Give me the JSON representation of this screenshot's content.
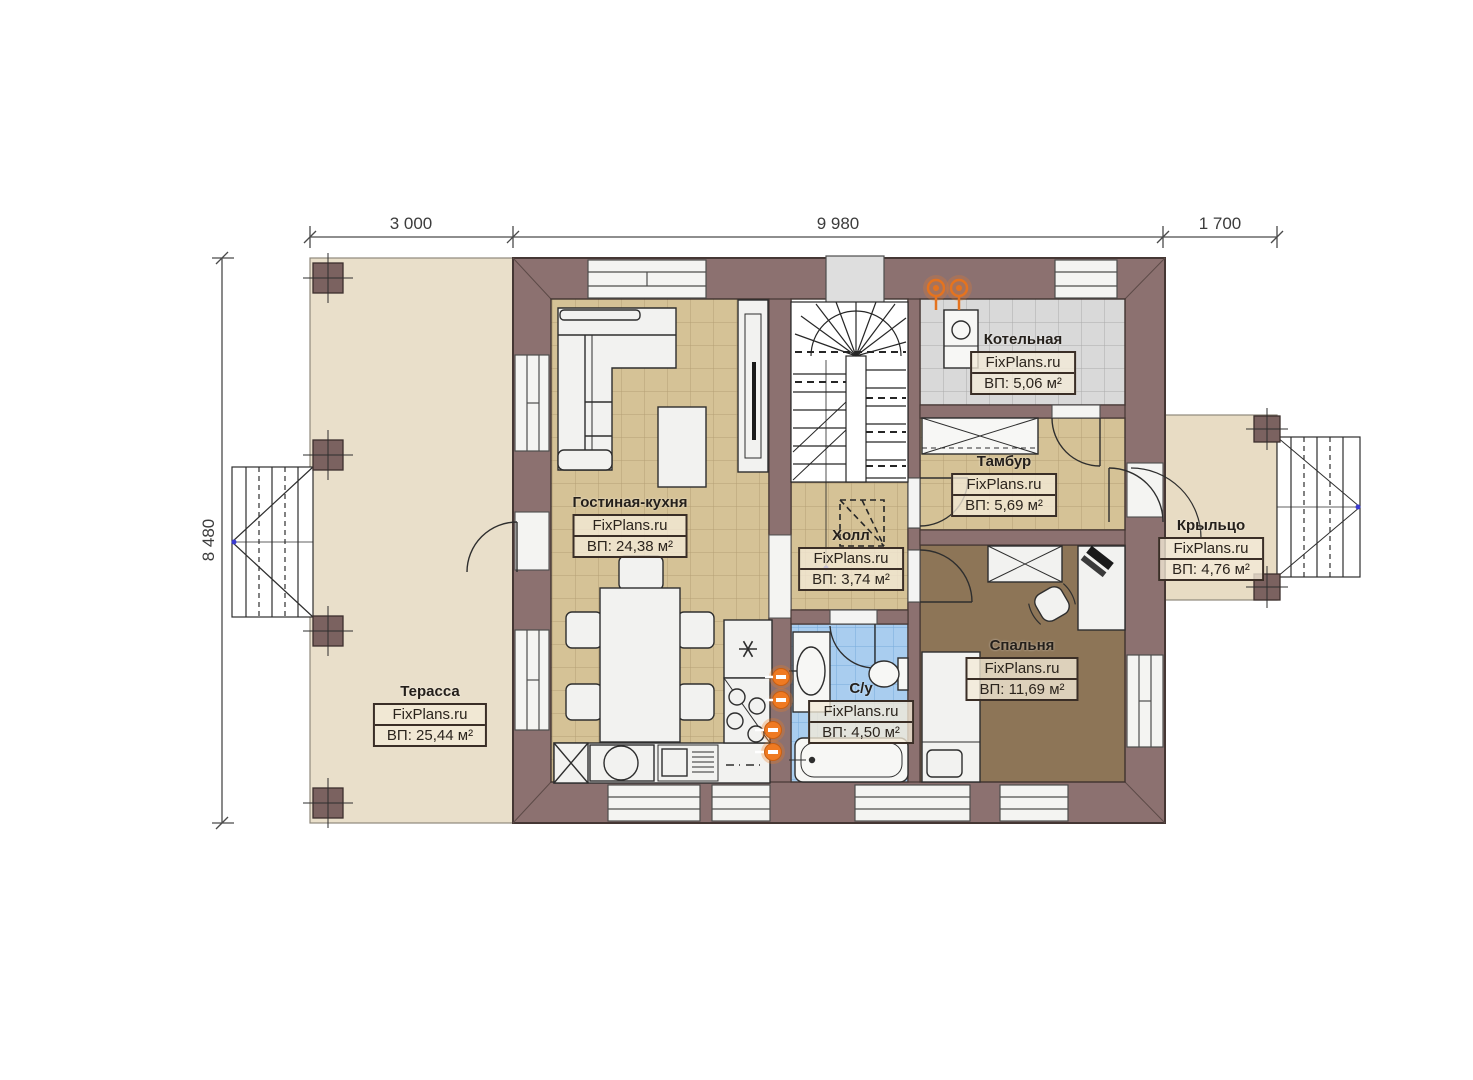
{
  "watermark": "FixPlans.ru",
  "dimensions": {
    "top": [
      "3 000",
      "9 980",
      "1 700"
    ],
    "left": "8 480"
  },
  "rooms": [
    {
      "name": "Терасса",
      "watermark": "FixPlans.ru",
      "area": "ВП: 25,44 м²"
    },
    {
      "name": "Гостиная-кухня",
      "watermark": "FixPlans.ru",
      "area": "ВП: 24,38 м²"
    },
    {
      "name": "Котельная",
      "watermark": "FixPlans.ru",
      "area": "ВП: 5,06 м²"
    },
    {
      "name": "Тамбур",
      "watermark": "FixPlans.ru",
      "area": "ВП: 5,69 м²"
    },
    {
      "name": "Холл",
      "watermark": "FixPlans.ru",
      "area": "ВП: 3,74 м²"
    },
    {
      "name": "С/у",
      "watermark": "FixPlans.ru",
      "area": "ВП: 4,50 м²"
    },
    {
      "name": "Спальня",
      "watermark": "FixPlans.ru",
      "area": "ВП: 11,69 м²"
    },
    {
      "name": "Крыльцо",
      "watermark": "FixPlans.ru",
      "area": "ВП: 4,76 м²"
    }
  ],
  "colors": {
    "wall": "#8c7170",
    "wall_outline": "#453734",
    "terrace_floor": "#e9dfca",
    "porch_floor": "#e8dcc4",
    "tile_tan": "#d5c296",
    "tile_gray": "#d9d9d9",
    "tile_blue": "#a9cdef",
    "bedroom_floor": "#8d7557",
    "accent_orange": "#ef7a22"
  }
}
